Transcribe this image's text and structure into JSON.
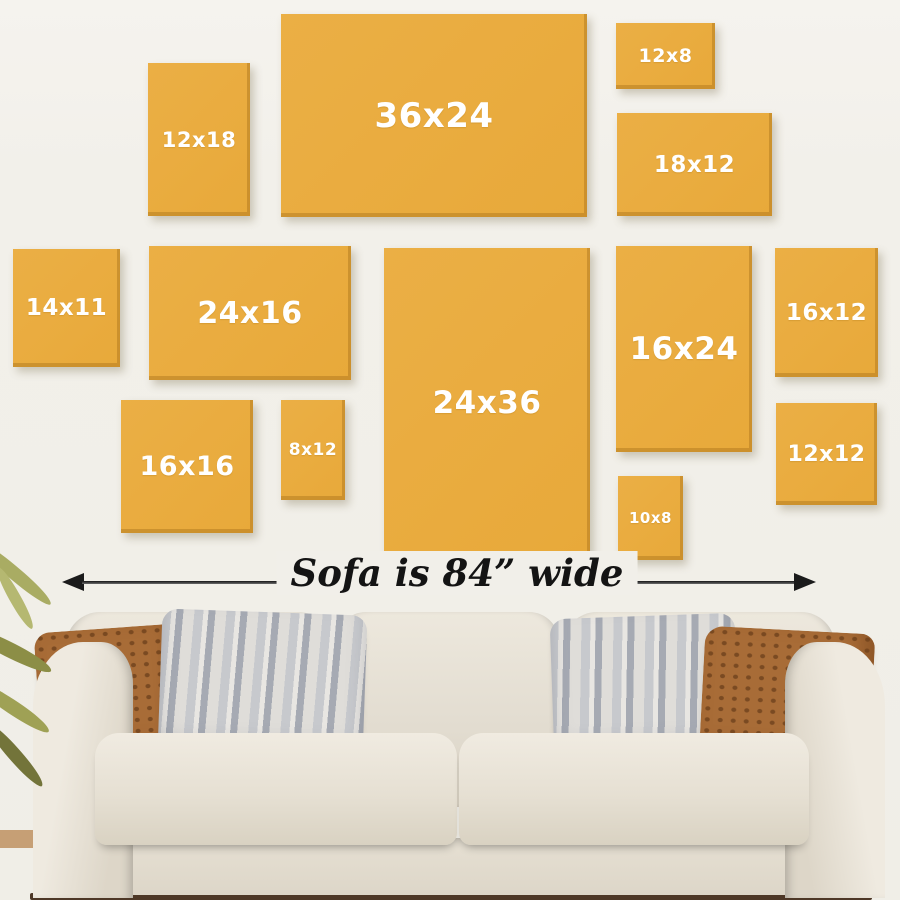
{
  "scene": {
    "description": "Wall art size guide showing canvas print sizes hung above a sofa",
    "wall_color": "#F2F0EA",
    "frame_color": "#E9AC3F",
    "frame_label_color": "#FFFFFF",
    "floor_color": "#4E3827",
    "sofa_color": "#E6E0D3",
    "pillow_colors": [
      "#A86C37",
      "#C7C9CD"
    ]
  },
  "frames": [
    {
      "label": "12x18"
    },
    {
      "label": "36x24"
    },
    {
      "label": "12x8"
    },
    {
      "label": "18x12"
    },
    {
      "label": "14x11"
    },
    {
      "label": "24x16"
    },
    {
      "label": "24x36"
    },
    {
      "label": "16x24"
    },
    {
      "label": "16x12"
    },
    {
      "label": "16x16"
    },
    {
      "label": "8x12"
    },
    {
      "label": "10x8"
    },
    {
      "label": "12x12"
    }
  ],
  "sofa": {
    "caption": "Sofa is 84” wide"
  }
}
